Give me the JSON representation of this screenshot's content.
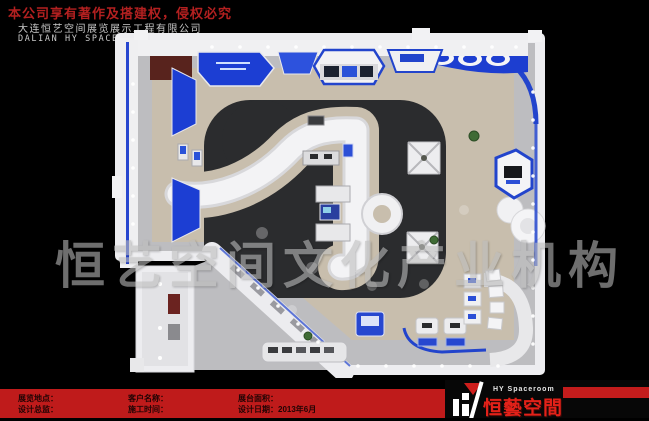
{
  "header": {
    "copyright_notice": "本公司享有著作及搭建权，侵权必究",
    "company_name_cn": "大连恒艺空间展览展示工程有限公司",
    "company_name_en": "DALIAN HY SPACEROOM EXHIBITION CO.，LTD"
  },
  "watermark_text": "恒艺空间文化产业机构",
  "render": {
    "alt": "exhibition-booth-top-view-3d-render"
  },
  "title_block": {
    "fields": [
      {
        "label": "展览地点：",
        "value": ""
      },
      {
        "label": "设计总监：",
        "value": ""
      },
      {
        "label": "客户名称：",
        "value": ""
      },
      {
        "label": "施工时间：",
        "value": ""
      },
      {
        "label": "展台面积：",
        "value": ""
      },
      {
        "label": "设计日期：",
        "value": "2013年6月"
      }
    ]
  },
  "logo": {
    "brand_en": "HY Spaceroom",
    "brand_cn": "恒藝空間"
  },
  "colors": {
    "background": "#000000",
    "copyright_red": "#b32020",
    "band_red": "#bf1b1b",
    "logo_red": "#e32119",
    "accent_blue": "#1c3ed3",
    "wall_white": "#f0f0f2",
    "floor_dark": "#2b2c2e",
    "carpet_beige": "#c8bead",
    "watermark_grey": "#bdbdbd"
  }
}
